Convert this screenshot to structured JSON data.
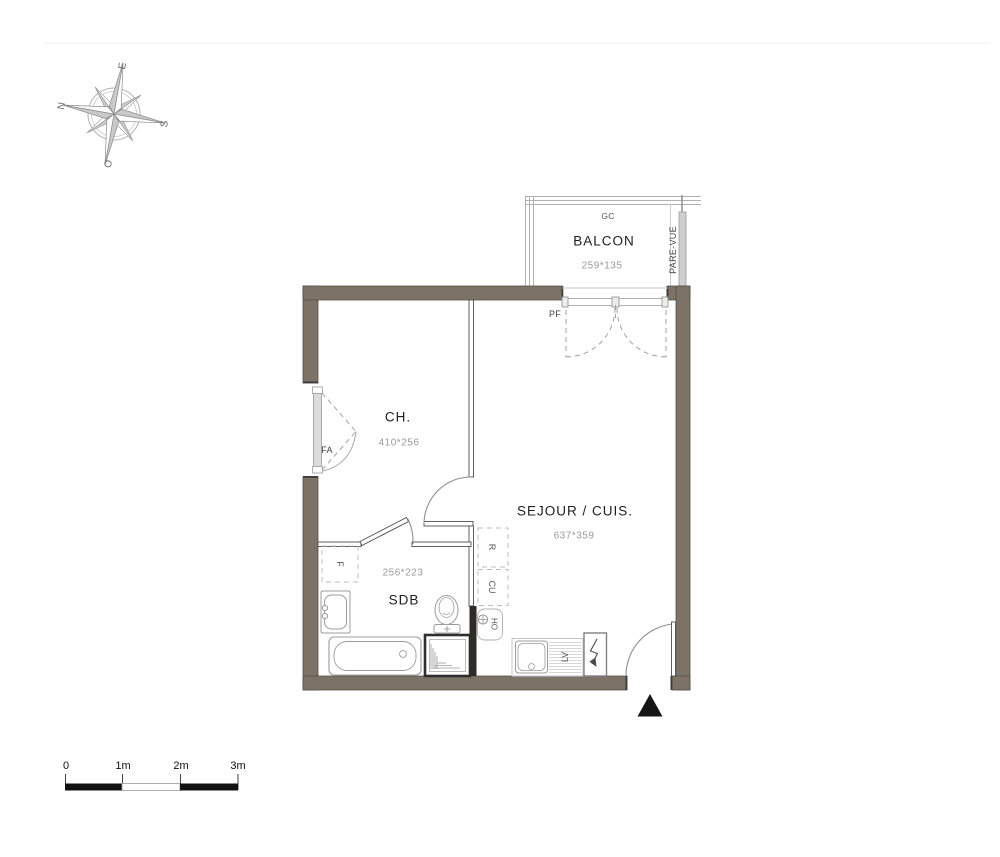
{
  "compass": {
    "east": "E",
    "north": "N",
    "south": "S",
    "west": "O"
  },
  "balcony": {
    "railing_label": "GC",
    "name": "BALCON",
    "dim": "259*135",
    "screen_label": "PARE-VUE"
  },
  "openings": {
    "balcony_door": "PF",
    "bedroom_window": "FA"
  },
  "rooms": {
    "bedroom": {
      "name": "CH.",
      "dim": "410*256"
    },
    "living_kitchen": {
      "name": "SEJOUR / CUIS.",
      "dim": "637*359"
    },
    "bathroom": {
      "name": "SDB",
      "dim": "256*223"
    }
  },
  "labels": {
    "bathroom_f": "F",
    "fridge": "R",
    "kitchen_unit": "CU",
    "water_point": "HO",
    "dishwasher": "LV"
  },
  "scale_bar": {
    "ticks": [
      "0",
      "1m",
      "2m",
      "3m"
    ]
  },
  "colors": {
    "wall": "#7c7366",
    "black_wall": "#2f2b27",
    "railing": "#adadad",
    "dashed": "#a0a0a0",
    "text": "#1e1e1e",
    "dim_text": "#9a9a9a"
  }
}
